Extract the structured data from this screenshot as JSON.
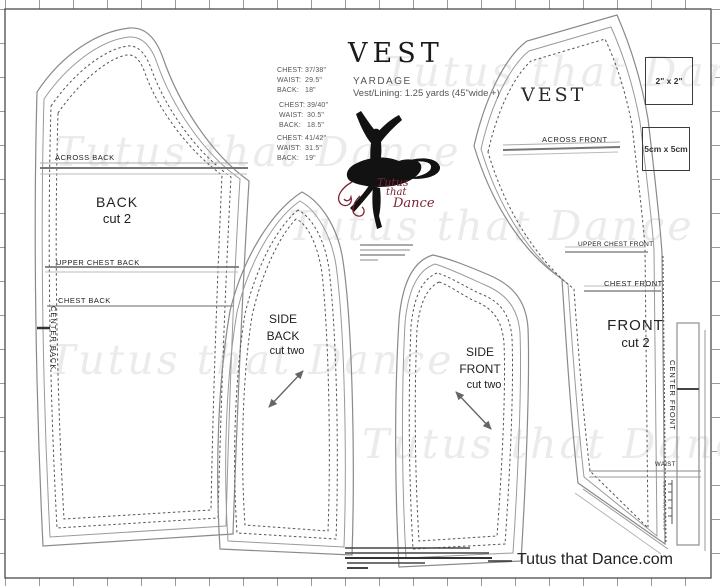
{
  "page": {
    "footer": "Tutus that Dance.com",
    "watermark": "Tutus that Dance"
  },
  "title_block": {
    "title": "VEST",
    "yardage_heading": "YARDAGE",
    "yardage_detail": "Vest/Lining: 1.25 yards  (45\"wide +)"
  },
  "size_charts": [
    {
      "rows": [
        {
          "label": "CHEST:",
          "value": "37/38\""
        },
        {
          "label": "WAIST:",
          "value": "29.5\""
        },
        {
          "label": "BACK:",
          "value": "18\""
        }
      ]
    },
    {
      "rows": [
        {
          "label": "CHEST:",
          "value": "39/40\""
        },
        {
          "label": "WAIST:",
          "value": "30.5\""
        },
        {
          "label": "BACK:",
          "value": "18.5\""
        }
      ]
    },
    {
      "rows": [
        {
          "label": "CHEST:",
          "value": "41/42\""
        },
        {
          "label": "WAIST:",
          "value": "31.5\""
        },
        {
          "label": "BACK:",
          "value": "19\""
        }
      ]
    }
  ],
  "logo": {
    "word1": "Tutus",
    "word2": "that",
    "word3": "Dance"
  },
  "pieces": {
    "back": {
      "across": "ACROSS BACK",
      "name": "BACK",
      "cut": "cut 2",
      "upper_chest": "UPPER CHEST BACK",
      "chest": "CHEST BACK",
      "center": "CENTER BACK"
    },
    "side_back": {
      "line1": "SIDE",
      "line2": "BACK",
      "cut": "cut two"
    },
    "side_front": {
      "line1": "SIDE",
      "line2": "FRONT",
      "cut": "cut two"
    },
    "front": {
      "header": "VEST",
      "across": "ACROSS FRONT",
      "upper_chest": "UPPER CHEST FRONT",
      "chest": "CHEST FRONT",
      "name": "FRONT",
      "cut": "cut 2",
      "center": "CENTER FRONT",
      "waist": "WAIST",
      "note": "Tutus that Dance"
    }
  },
  "test_squares": {
    "inch": "2\" x 2\"",
    "metric": "5cm x 5cm"
  },
  "colors": {
    "accent": "#7b2433",
    "line": "#777777",
    "watermark": "#eceaea"
  }
}
